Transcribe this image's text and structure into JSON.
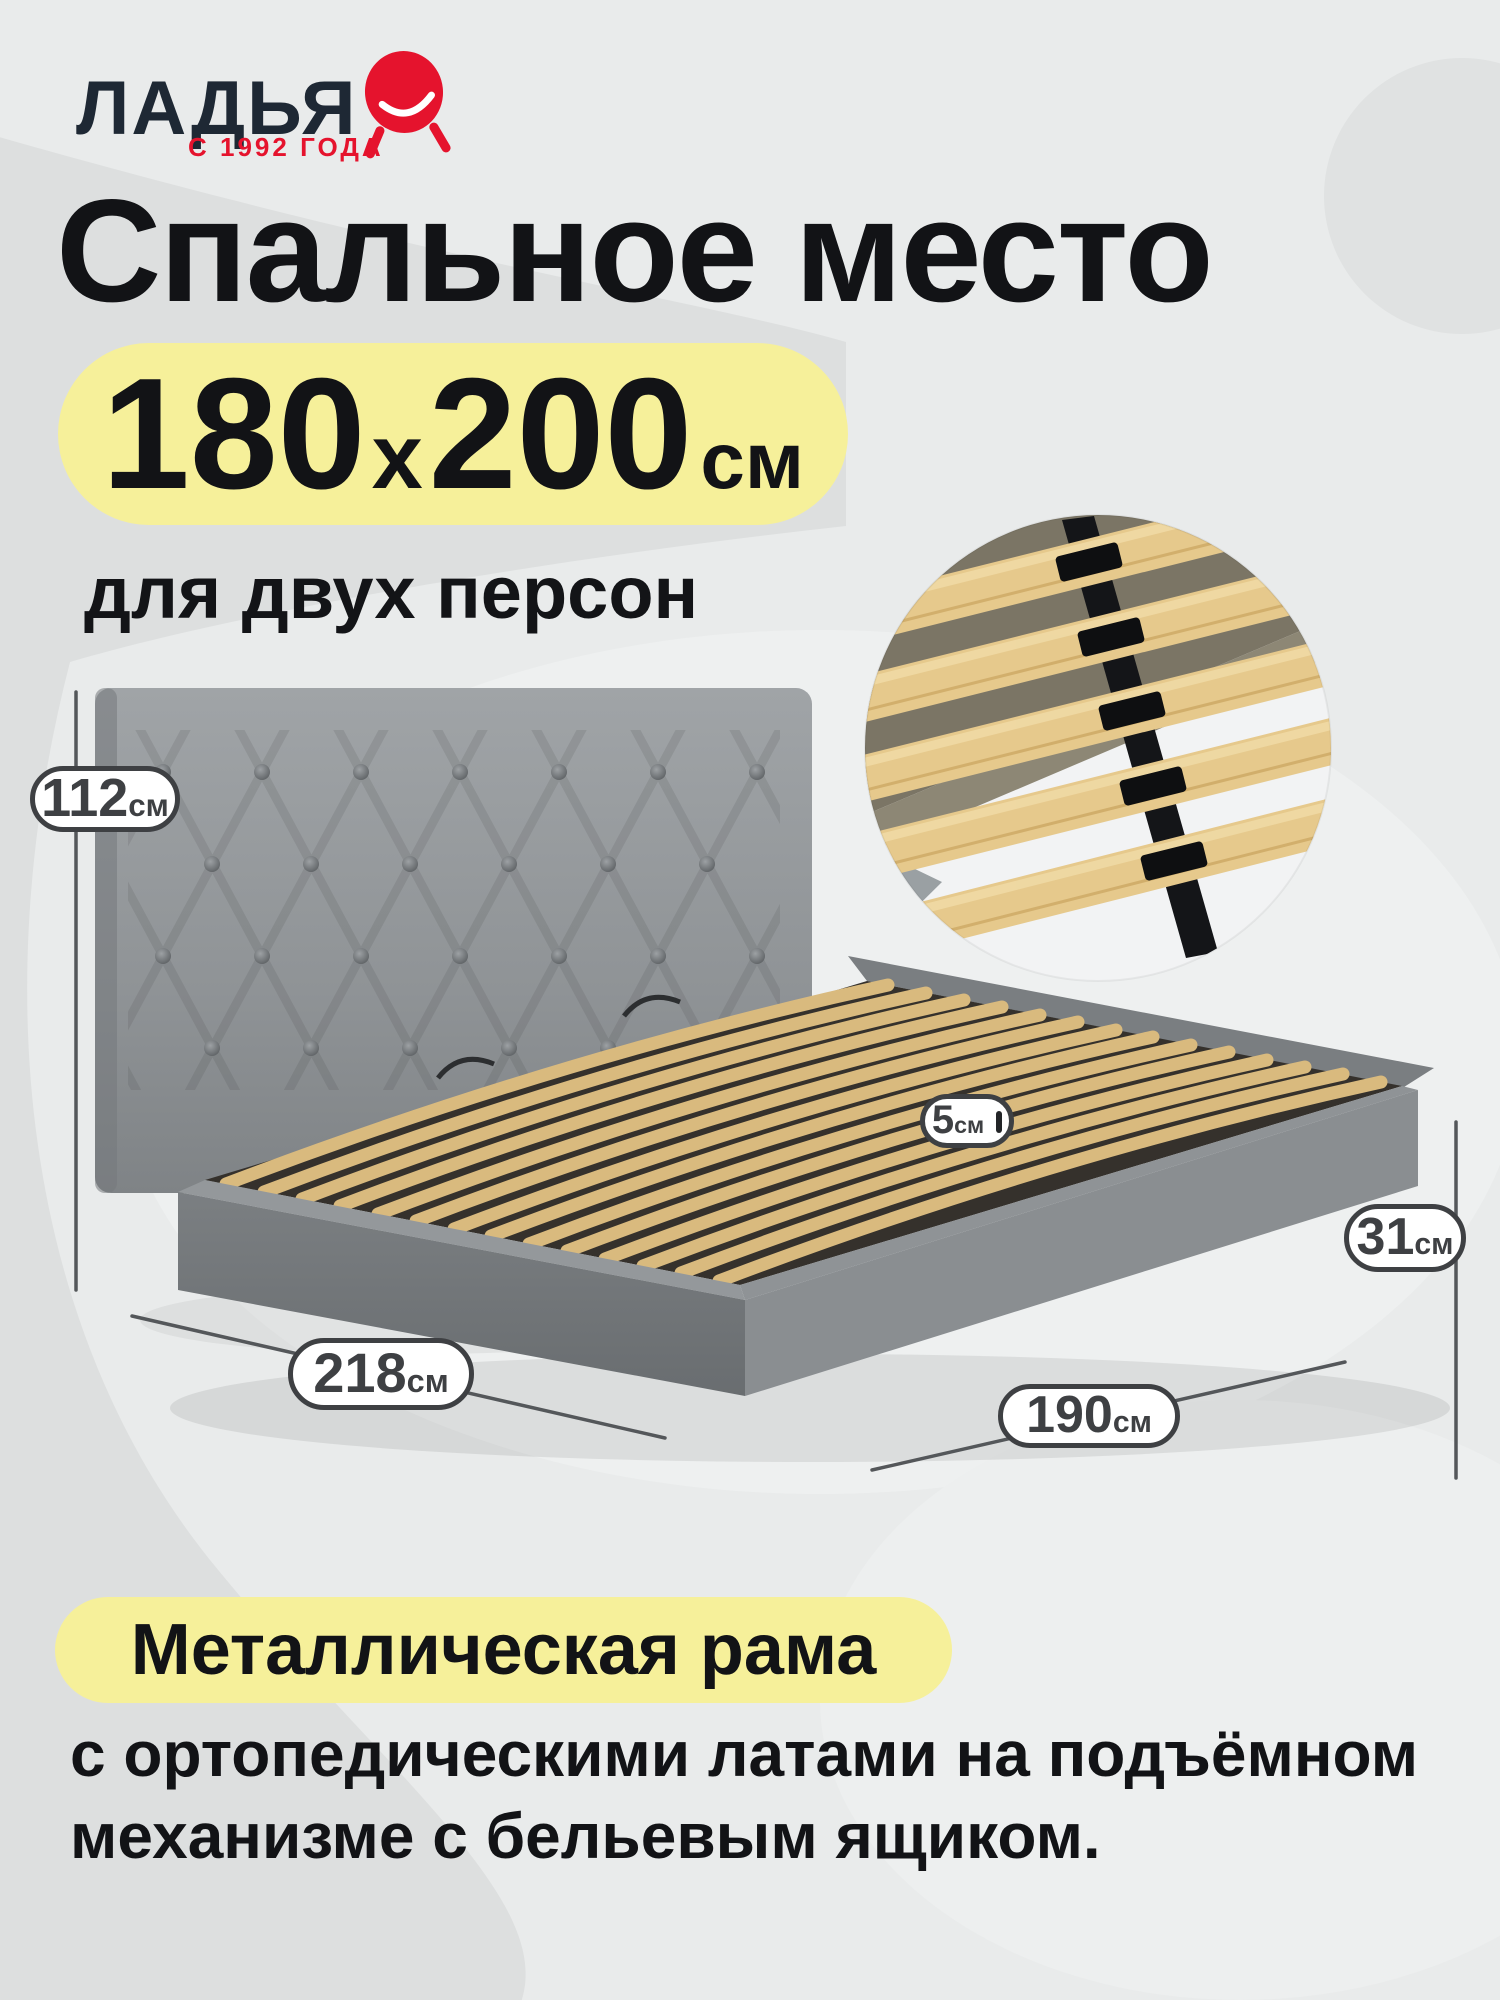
{
  "brand": {
    "name": "ЛАДЬЯ",
    "tagline": "С 1992 ГОДА",
    "navy_color": "#1e2834",
    "red_color": "#e5132d",
    "logo_icon": "pouf-smile-icon"
  },
  "hero": {
    "title": "Спальное место",
    "size_first": "180",
    "size_sep": "x",
    "size_second": "200",
    "size_unit": "см",
    "subtitle": "для двух персон",
    "highlight_color": "#f6f09a"
  },
  "dimensions": [
    {
      "name": "headboard-height",
      "value": "112",
      "unit": "см"
    },
    {
      "name": "slat-width",
      "value": "5",
      "unit": "см"
    },
    {
      "name": "base-height",
      "value": "31",
      "unit": "см"
    },
    {
      "name": "bed-length",
      "value": "218",
      "unit": "см"
    },
    {
      "name": "bed-width",
      "value": "190",
      "unit": "см"
    }
  ],
  "badge_style": {
    "border_color": "#3e4043",
    "text_color": "#3e4043",
    "bg_color": "#ffffff"
  },
  "images": [
    {
      "name": "bed-photo",
      "description": "gray velvet bed with tufted headboard and wooden orthopedic slats"
    },
    {
      "name": "slats-inset-photo",
      "description": "close-up circle of wooden slats with black frame clips"
    }
  ],
  "footer": {
    "highlight_text": "Металлическая рама",
    "line1": "с ортопедическими латами на подъёмном",
    "line2": "механизме с бельевым ящиком.",
    "highlight_color": "#f6f09a"
  }
}
